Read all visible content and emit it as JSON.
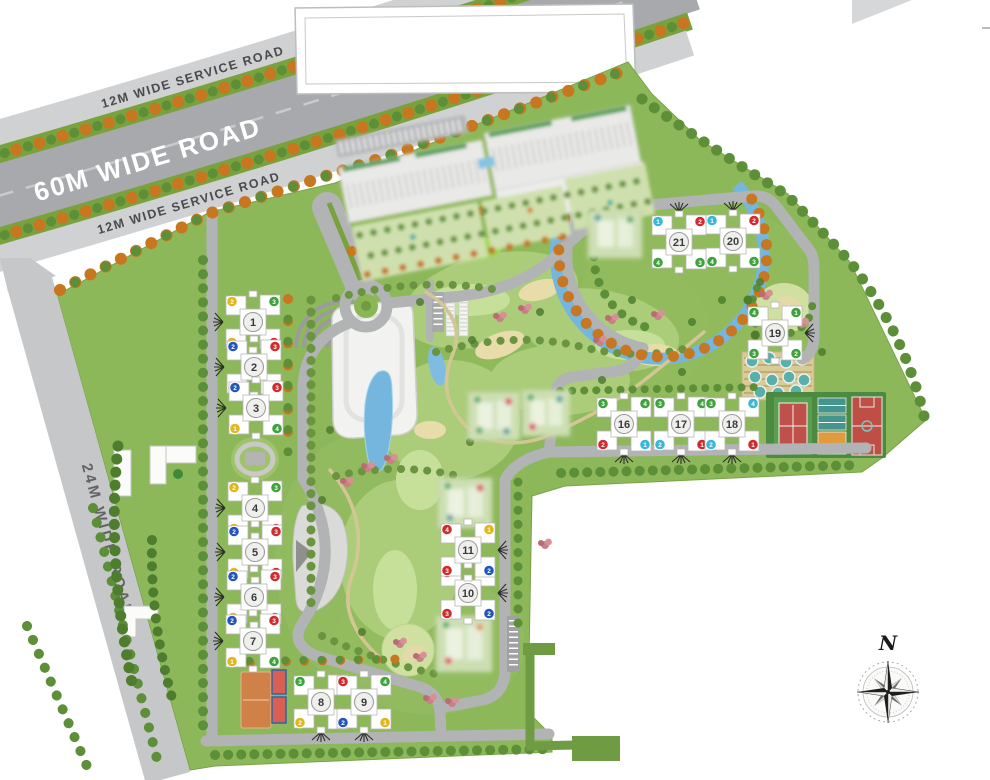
{
  "roads": {
    "main_road": "60M WIDE ROAD",
    "service_road_north": "12M WIDE SERVICE ROAD",
    "service_road_south": "12M WIDE SERVICE ROAD",
    "west_road": "24M WIDE ROAD"
  },
  "compass": {
    "north": "N"
  },
  "dot_colors": {
    "yellow": "#e2b71e",
    "green": "#3fa33c",
    "red": "#d12b2e",
    "blue": "#2356bb",
    "cyan": "#39b7d8",
    "teal": "#3a9a8a",
    "orange": "#d98a2e"
  },
  "buildings": [
    {
      "number": "1",
      "x": 253,
      "y": 322,
      "entry": "w",
      "wings": [
        {
          "label": "2",
          "color": "yellow"
        },
        {
          "label": "3",
          "color": "green"
        },
        {
          "label": "1",
          "color": "yellow"
        },
        {
          "label": "4",
          "color": "red"
        }
      ]
    },
    {
      "number": "2",
      "x": 254,
      "y": 367,
      "entry": "w",
      "wings": [
        {
          "label": "2",
          "color": "blue"
        },
        {
          "label": "3",
          "color": "red"
        },
        {
          "label": "1",
          "color": "yellow"
        },
        {
          "label": "4",
          "color": "red"
        }
      ]
    },
    {
      "number": "3",
      "x": 256,
      "y": 408,
      "entry": "w",
      "wings": [
        {
          "label": "2",
          "color": "blue"
        },
        {
          "label": "3",
          "color": "red"
        },
        {
          "label": "1",
          "color": "yellow"
        },
        {
          "label": "4",
          "color": "green"
        }
      ]
    },
    {
      "number": "4",
      "x": 255,
      "y": 508,
      "entry": "w",
      "wings": [
        {
          "label": "2",
          "color": "yellow"
        },
        {
          "label": "3",
          "color": "green"
        },
        {
          "label": "1",
          "color": "yellow"
        },
        {
          "label": "4",
          "color": "red"
        }
      ]
    },
    {
      "number": "5",
      "x": 255,
      "y": 552,
      "entry": "w",
      "wings": [
        {
          "label": "2",
          "color": "blue"
        },
        {
          "label": "3",
          "color": "red"
        },
        {
          "label": "1",
          "color": "yellow"
        },
        {
          "label": "4",
          "color": "red"
        }
      ]
    },
    {
      "number": "6",
      "x": 254,
      "y": 597,
      "entry": "w",
      "wings": [
        {
          "label": "2",
          "color": "blue"
        },
        {
          "label": "3",
          "color": "red"
        },
        {
          "label": "1",
          "color": "yellow"
        },
        {
          "label": "4",
          "color": "red"
        }
      ]
    },
    {
      "number": "7",
      "x": 253,
      "y": 641,
      "entry": "w",
      "wings": [
        {
          "label": "2",
          "color": "blue"
        },
        {
          "label": "3",
          "color": "red"
        },
        {
          "label": "1",
          "color": "yellow"
        },
        {
          "label": "4",
          "color": "green"
        }
      ]
    },
    {
      "number": "8",
      "x": 321,
      "y": 702,
      "entry": "s",
      "wings": [
        {
          "label": "3",
          "color": "green"
        },
        {
          "label": "4",
          "color": "red"
        },
        {
          "label": "2",
          "color": "yellow"
        },
        {
          "label": "1",
          "color": "yellow"
        }
      ]
    },
    {
      "number": "9",
      "x": 364,
      "y": 702,
      "entry": "s",
      "wings": [
        {
          "label": "3",
          "color": "red"
        },
        {
          "label": "4",
          "color": "green"
        },
        {
          "label": "2",
          "color": "blue"
        },
        {
          "label": "1",
          "color": "yellow"
        }
      ]
    },
    {
      "number": "10",
      "x": 468,
      "y": 593,
      "entry": "e",
      "wings": [
        {
          "label": "4",
          "color": "red"
        },
        {
          "label": "1",
          "color": "yellow"
        },
        {
          "label": "3",
          "color": "red"
        },
        {
          "label": "2",
          "color": "blue"
        }
      ]
    },
    {
      "number": "11",
      "x": 468,
      "y": 550,
      "entry": "e",
      "wings": [
        {
          "label": "4",
          "color": "red"
        },
        {
          "label": "1",
          "color": "yellow"
        },
        {
          "label": "3",
          "color": "red"
        },
        {
          "label": "2",
          "color": "blue"
        }
      ]
    },
    {
      "number": "16",
      "x": 624,
      "y": 424,
      "entry": "s",
      "wings": [
        {
          "label": "3",
          "color": "green"
        },
        {
          "label": "4",
          "color": "green"
        },
        {
          "label": "2",
          "color": "red"
        },
        {
          "label": "1",
          "color": "cyan"
        }
      ]
    },
    {
      "number": "17",
      "x": 681,
      "y": 424,
      "entry": "s",
      "wings": [
        {
          "label": "3",
          "color": "green"
        },
        {
          "label": "4",
          "color": "green"
        },
        {
          "label": "2",
          "color": "cyan"
        },
        {
          "label": "1",
          "color": "red"
        }
      ]
    },
    {
      "number": "18",
      "x": 732,
      "y": 424,
      "entry": "s",
      "wings": [
        {
          "label": "3",
          "color": "green"
        },
        {
          "label": "4",
          "color": "cyan"
        },
        {
          "label": "2",
          "color": "cyan"
        },
        {
          "label": "1",
          "color": "red"
        }
      ]
    },
    {
      "number": "19",
      "x": 775,
      "y": 333,
      "entry": "e",
      "wings": [
        {
          "label": "4",
          "color": "green"
        },
        {
          "label": "1",
          "color": "green"
        },
        {
          "label": "3",
          "color": "green"
        },
        {
          "label": "2",
          "color": "green"
        }
      ]
    },
    {
      "number": "20",
      "x": 733,
      "y": 241,
      "entry": "n",
      "wings": [
        {
          "label": "1",
          "color": "cyan"
        },
        {
          "label": "2",
          "color": "red"
        },
        {
          "label": "4",
          "color": "green"
        },
        {
          "label": "3",
          "color": "green"
        }
      ]
    },
    {
      "number": "21",
      "x": 679,
      "y": 242,
      "entry": "n",
      "wings": [
        {
          "label": "1",
          "color": "cyan"
        },
        {
          "label": "2",
          "color": "red"
        },
        {
          "label": "4",
          "color": "green"
        },
        {
          "label": "3",
          "color": "green"
        }
      ]
    }
  ],
  "ghost_blocks": [
    {
      "x": 468,
      "y": 392,
      "w": 52,
      "h": 48,
      "dots": [
        "green",
        "red",
        "green",
        "teal"
      ]
    },
    {
      "x": 522,
      "y": 390,
      "w": 48,
      "h": 46,
      "dots": [
        "green",
        "teal",
        "red"
      ]
    },
    {
      "x": 438,
      "y": 478,
      "w": 54,
      "h": 50,
      "dots": [
        "green",
        "red",
        "teal"
      ]
    },
    {
      "x": 436,
      "y": 616,
      "w": 56,
      "h": 56,
      "dots": [
        "green",
        "orange",
        "red"
      ]
    },
    {
      "x": 588,
      "y": 210,
      "w": 54,
      "h": 48,
      "dots": [
        "teal",
        "green"
      ]
    }
  ],
  "features": [
    "entrance-roundabout",
    "clubhouse",
    "pond",
    "amphitheatre-arcs",
    "open-air-theatre",
    "running-track",
    "golf-style-greens",
    "circular-stream",
    "tennis-court",
    "volleyball-courts",
    "half-basketball-court",
    "basketball-court",
    "kids-play-area",
    "terraced-garden-pools",
    "pergolas",
    "commercial-block",
    "parking-bays",
    "compass-rose"
  ]
}
